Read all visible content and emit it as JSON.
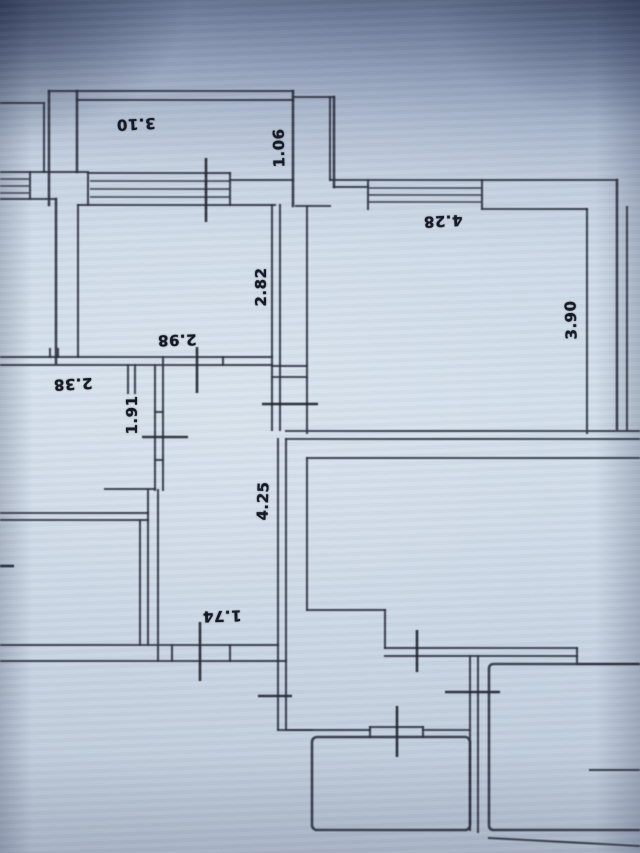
{
  "colors": {
    "paper": "#ccd9e7",
    "ink": "#2b2f3d"
  },
  "labels": {
    "l_3_10": "3.10",
    "l_1_06": "1.06",
    "l_4_28": "4.28",
    "l_2_82": "2.82",
    "l_3_90": "3.90",
    "l_2_98": "2.98",
    "l_2_38": "2.38",
    "l_1_91": "1.91",
    "l_4_25": "4.25",
    "l_1_74": "1.74"
  }
}
